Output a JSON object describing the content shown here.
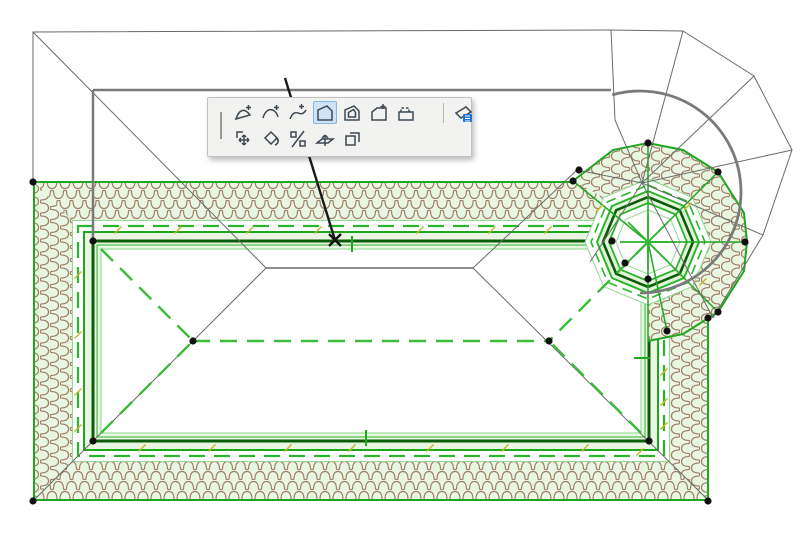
{
  "app": {
    "description": "Roof plan being edited in a CAD application with a floating polygon-edit pet palette",
    "selected_tool": "offset-edge"
  },
  "palette": {
    "rows": [
      {
        "tools": [
          {
            "name": "insert-node",
            "label": "Insert New Node",
            "selected": false
          },
          {
            "name": "curve-edge",
            "label": "Curve Edge",
            "selected": false
          },
          {
            "name": "curve-tangent",
            "label": "Curve Edge Tangentially",
            "selected": false
          },
          {
            "name": "offset-edge",
            "label": "Offset Edge",
            "selected": true
          },
          {
            "name": "offset-all-edges",
            "label": "Offset All Edges",
            "selected": false
          },
          {
            "name": "add-to-polygon",
            "label": "Add to Polygon",
            "selected": false
          },
          {
            "name": "subtract-from-polygon",
            "label": "Subtract from Polygon",
            "selected": false
          },
          {
            "name": "custom-edge-settings",
            "label": "Custom Edge Settings",
            "selected": false,
            "after_separator": true
          }
        ]
      },
      {
        "tools": [
          {
            "name": "drag",
            "label": "Drag",
            "selected": false
          },
          {
            "name": "rotate",
            "label": "Rotate",
            "selected": false
          },
          {
            "name": "mirror",
            "label": "Mirror",
            "selected": false
          },
          {
            "name": "elevate",
            "label": "Elevate",
            "selected": false
          },
          {
            "name": "multiply",
            "label": "Multiply",
            "selected": false
          }
        ]
      }
    ],
    "highlight_bg": "#cfe3f8",
    "highlight_border": "#8ab4e0",
    "icon_stroke": "#3d4752",
    "badge_color": "#1e73d2"
  },
  "drawing": {
    "colors": {
      "roof_bright_green": "#1fa81f",
      "roof_mid_green": "#2ab52a",
      "roof_dark_green": "#0b5c0b",
      "roof_light_green_line": "#93d893",
      "band_fill": "#e9f7e2",
      "tile_brown": "#a1806a",
      "wire_gray": "#6a6a6a",
      "wall_gray": "#7a7a7a",
      "handle_black": "#111111",
      "tick_yellow": "#c9b62e",
      "dash_green": "#3cbb3c"
    },
    "main_roof": {
      "outer_rect": [
        34,
        182,
        708,
        500
      ],
      "inner_rect": [
        101,
        249,
        641,
        433
      ],
      "ridge": [
        [
          193,
          341
        ],
        [
          549,
          341
        ]
      ]
    },
    "turret": {
      "center": [
        648,
        242
      ],
      "outer_radius": 99
    },
    "handles": [
      {
        "x": 33,
        "y": 182
      },
      {
        "x": 93,
        "y": 241
      },
      {
        "x": 193,
        "y": 341
      },
      {
        "x": 549,
        "y": 341
      },
      {
        "x": 93,
        "y": 441
      },
      {
        "x": 33,
        "y": 501
      },
      {
        "x": 649,
        "y": 441
      },
      {
        "x": 708,
        "y": 501
      },
      {
        "x": 573,
        "y": 181
      },
      {
        "x": 579,
        "y": 170
      },
      {
        "x": 648,
        "y": 143
      },
      {
        "x": 718,
        "y": 172
      },
      {
        "x": 745,
        "y": 242
      },
      {
        "x": 718,
        "y": 312
      },
      {
        "x": 708,
        "y": 318
      },
      {
        "x": 667,
        "y": 331
      },
      {
        "x": 612,
        "y": 241
      },
      {
        "x": 625,
        "y": 263
      },
      {
        "x": 648,
        "y": 279
      }
    ],
    "yellow_ticks": [
      {
        "x": 118,
        "y": 230
      },
      {
        "x": 178,
        "y": 230
      },
      {
        "x": 250,
        "y": 230
      },
      {
        "x": 318,
        "y": 230
      },
      {
        "x": 420,
        "y": 230
      },
      {
        "x": 492,
        "y": 230
      },
      {
        "x": 548,
        "y": 230
      },
      {
        "x": 78,
        "y": 275
      },
      {
        "x": 78,
        "y": 335
      },
      {
        "x": 78,
        "y": 392
      },
      {
        "x": 78,
        "y": 428
      },
      {
        "x": 142,
        "y": 448
      },
      {
        "x": 212,
        "y": 448
      },
      {
        "x": 288,
        "y": 448
      },
      {
        "x": 352,
        "y": 448
      },
      {
        "x": 430,
        "y": 448
      },
      {
        "x": 505,
        "y": 448
      },
      {
        "x": 585,
        "y": 448
      },
      {
        "x": 640,
        "y": 452
      },
      {
        "x": 664,
        "y": 372
      },
      {
        "x": 664,
        "y": 402
      },
      {
        "x": 664,
        "y": 426
      },
      {
        "x": 600,
        "y": 208
      },
      {
        "x": 688,
        "y": 206
      },
      {
        "x": 703,
        "y": 282
      }
    ],
    "green_ticks": [
      {
        "x1": 352,
        "y1": 236,
        "x2": 352,
        "y2": 252
      },
      {
        "x1": 366,
        "y1": 430,
        "x2": 366,
        "y2": 446
      },
      {
        "x1": 634,
        "y1": 358,
        "x2": 650,
        "y2": 358
      }
    ],
    "edit_marker": {
      "x": 335,
      "y": 240,
      "leader_from": [
        285,
        78
      ]
    }
  }
}
